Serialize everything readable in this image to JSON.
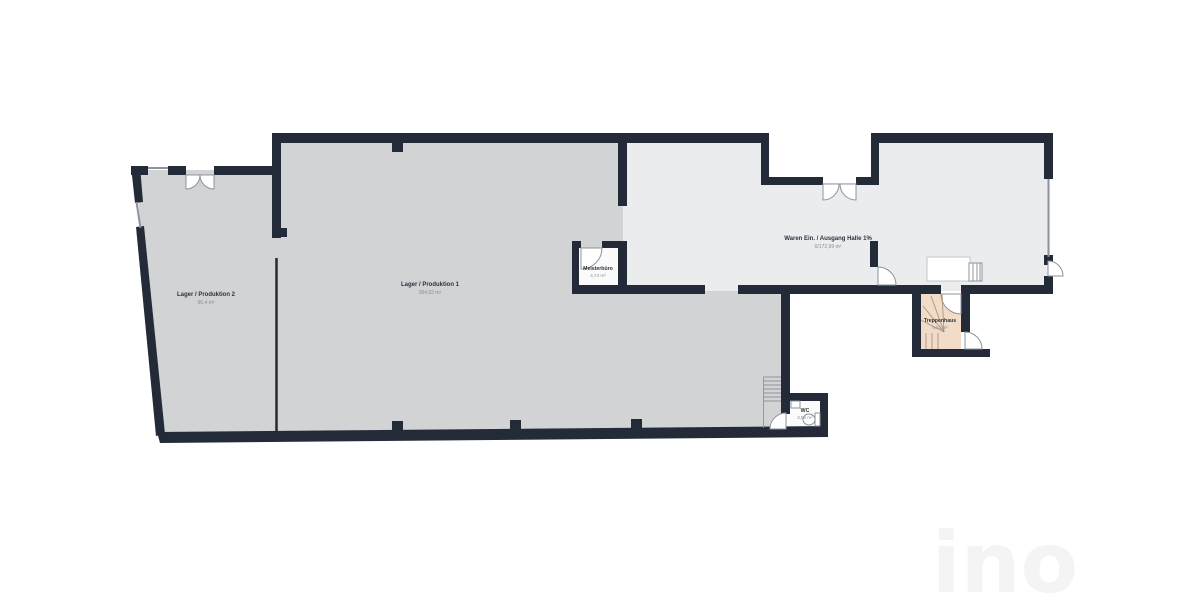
{
  "rooms": {
    "lager2": {
      "name": "Lager / Produktion 2",
      "area": "96,4 m²"
    },
    "lager1": {
      "name": "Lager / Produktion 1",
      "area": "364,53 m²"
    },
    "meisterbuero": {
      "name": "Meisterbüro",
      "area": "4,74 m²"
    },
    "halle": {
      "name": "Waren Ein. / Ausgang Halle 1%",
      "area": "0/172,99 m²"
    },
    "treppenhaus": {
      "name": "Treppenhaus",
      "area": "5,51 m²"
    },
    "wc": {
      "name": "WC",
      "area": "3,55 m²"
    }
  },
  "watermark": {
    "text": "ino"
  },
  "colors": {
    "wall": "#222b37",
    "room_fill": "#d2d3d5",
    "hall_fill": "#ebecee",
    "stair_fill": "#f2dcc8",
    "cabin_fill": "#fbfbfb",
    "outline": "#8d939c",
    "stair_line": "#a59486",
    "label": "#2b3340",
    "label_muted": "#878d97",
    "watermark": "#f4f4f5",
    "background": "#ffffff"
  }
}
